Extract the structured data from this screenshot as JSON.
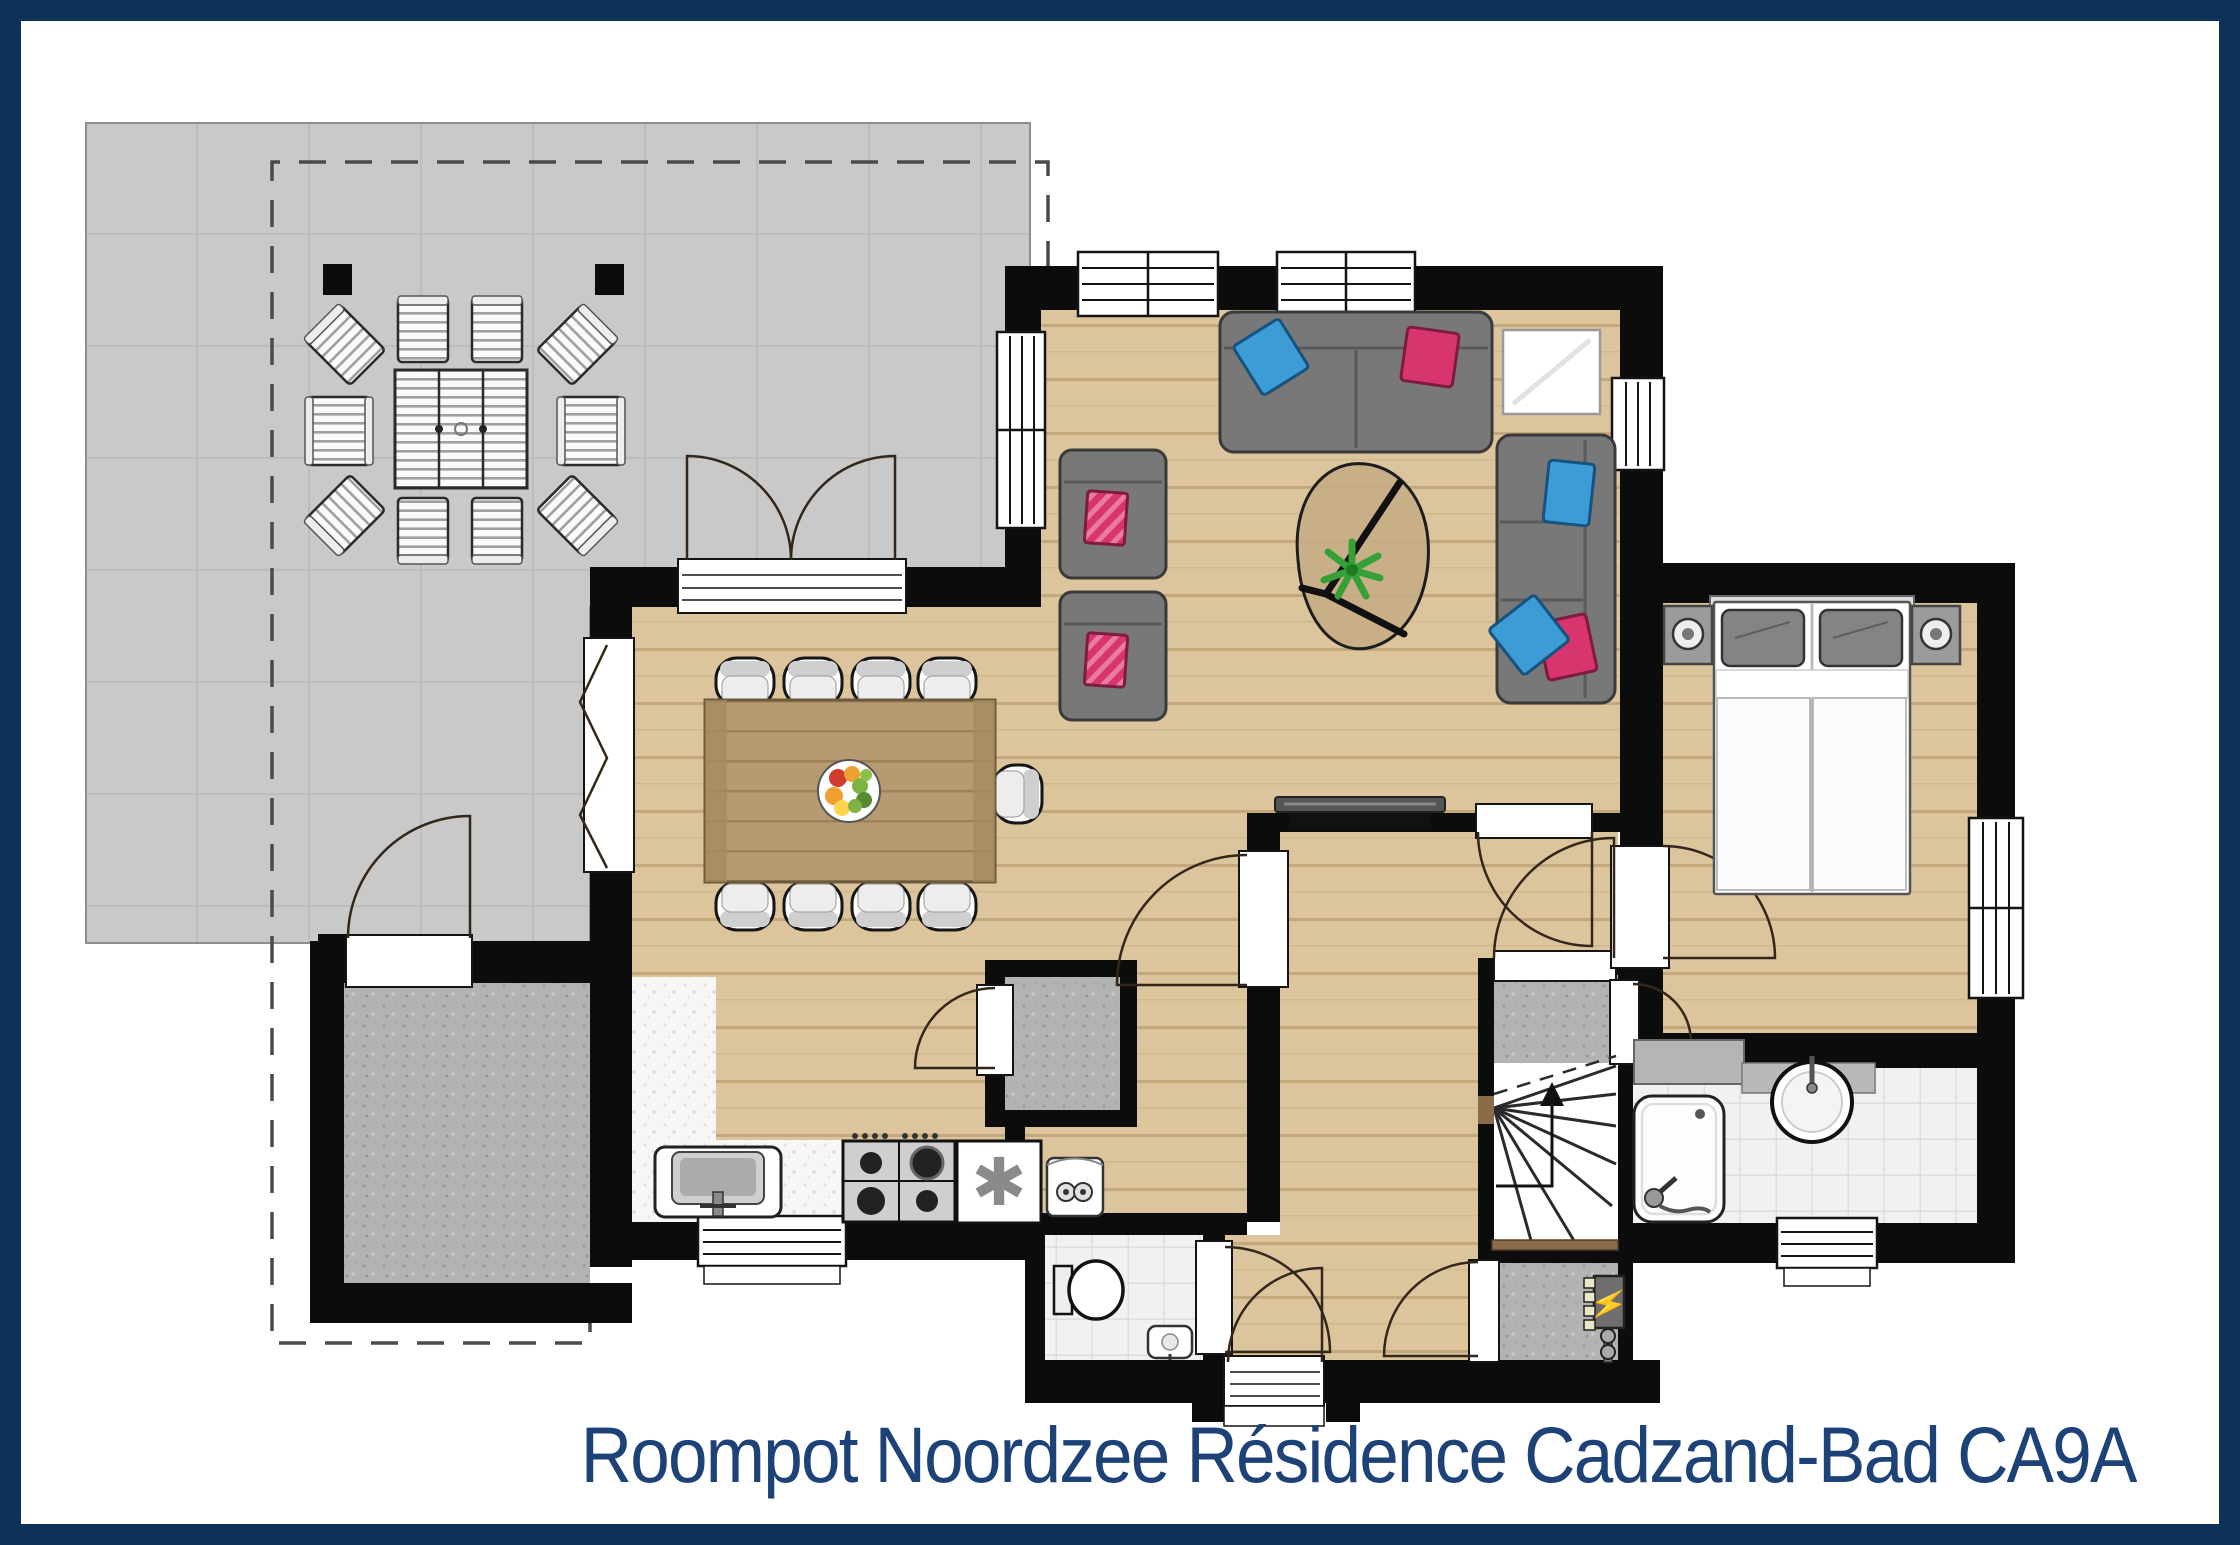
{
  "title": {
    "text": "Roompot Noordzee Résidence Cadzand-Bad CA9A"
  },
  "icons": {
    "freezer_glyph": "✱",
    "electrical_glyph": "⚡"
  },
  "palette": {
    "border_navy": "#0e3159",
    "title_navy": "#1d4278",
    "wall_black": "#0c0c0c",
    "wood_floor": "#dcc49d",
    "table_wood": "#b59a72",
    "terrace_gray": "#c9c9c9",
    "speckle_gray": "#b3b3b3",
    "tile_white": "#f1f1f1",
    "sofa_gray": "#787878",
    "pillow_pink": "#d8356f",
    "pillow_blue": "#3d9bd5",
    "plant_green": "#3aa83a",
    "bolt_yellow": "#ffe000"
  }
}
